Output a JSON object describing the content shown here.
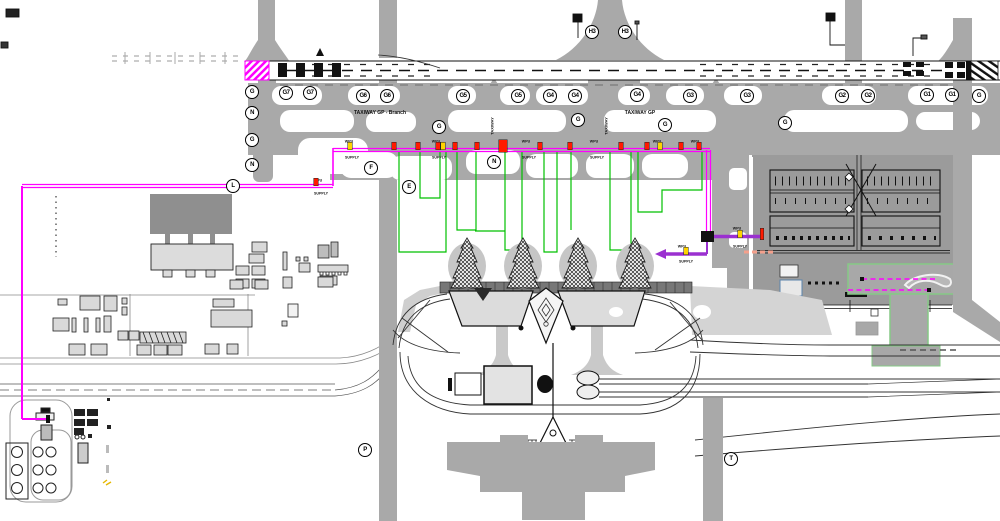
{
  "drawing": {
    "colors": {
      "magenta": "#FF00FF",
      "purple": "#9B30D0",
      "green": "#00C000",
      "red": "#FF1A00",
      "yellow": "#FFD300",
      "salmon": "#F4A08C",
      "band_gray": "#A9A9A9",
      "apron_gray": "#9B9B9B",
      "dark_gray": "#6E6E6E"
    },
    "circle_labels": [
      {
        "t": "G",
        "x": 252,
        "y": 92
      },
      {
        "t": "N",
        "x": 252,
        "y": 113
      },
      {
        "t": "G",
        "x": 252,
        "y": 140
      },
      {
        "t": "N",
        "x": 252,
        "y": 165
      },
      {
        "t": "G7",
        "x": 286,
        "y": 93
      },
      {
        "t": "G7",
        "x": 310,
        "y": 93
      },
      {
        "t": "G6",
        "x": 363,
        "y": 96
      },
      {
        "t": "G6",
        "x": 387,
        "y": 96
      },
      {
        "t": "G5",
        "x": 463,
        "y": 96
      },
      {
        "t": "G5",
        "x": 518,
        "y": 96
      },
      {
        "t": "G4",
        "x": 550,
        "y": 96
      },
      {
        "t": "G4",
        "x": 575,
        "y": 96
      },
      {
        "t": "G4",
        "x": 637,
        "y": 95
      },
      {
        "t": "G3",
        "x": 690,
        "y": 96
      },
      {
        "t": "G3",
        "x": 747,
        "y": 96
      },
      {
        "t": "G2",
        "x": 842,
        "y": 96
      },
      {
        "t": "G2",
        "x": 868,
        "y": 96
      },
      {
        "t": "G1",
        "x": 927,
        "y": 95
      },
      {
        "t": "G1",
        "x": 952,
        "y": 95
      },
      {
        "t": "G",
        "x": 979,
        "y": 96
      },
      {
        "t": "H3",
        "x": 592,
        "y": 32
      },
      {
        "t": "H3",
        "x": 625,
        "y": 32
      },
      {
        "t": "G",
        "x": 439,
        "y": 127
      },
      {
        "t": "G",
        "x": 578,
        "y": 120
      },
      {
        "t": "G",
        "x": 665,
        "y": 125
      },
      {
        "t": "G",
        "x": 785,
        "y": 123
      },
      {
        "t": "F",
        "x": 371,
        "y": 168
      },
      {
        "t": "N",
        "x": 494,
        "y": 162
      },
      {
        "t": "E",
        "x": 409,
        "y": 187
      },
      {
        "t": "L",
        "x": 233,
        "y": 186
      },
      {
        "t": "P",
        "x": 365,
        "y": 450
      },
      {
        "t": "T",
        "x": 731,
        "y": 459
      }
    ],
    "text_labels": [
      {
        "t": "TAXIWAY GP - Branch",
        "x": 380,
        "y": 113,
        "cls": "t5"
      },
      {
        "t": "TAXIWAY GP",
        "x": 640,
        "y": 113,
        "cls": "t5"
      },
      {
        "t": "TAXIWAY",
        "x": 492,
        "y": 126,
        "cls": "t4 vert"
      },
      {
        "t": "TAXIWAY",
        "x": 606,
        "y": 126,
        "cls": "t4 vert"
      },
      {
        "t": "WPU",
        "x": 349,
        "y": 141,
        "cls": "t4"
      },
      {
        "t": "SUPPLY",
        "x": 352,
        "y": 157,
        "cls": "t4"
      },
      {
        "t": "WPU",
        "x": 318,
        "y": 180,
        "cls": "t4"
      },
      {
        "t": "SUPPLY",
        "x": 321,
        "y": 193,
        "cls": "t4"
      },
      {
        "t": "WPU",
        "x": 436,
        "y": 141,
        "cls": "t4"
      },
      {
        "t": "SUPPLY",
        "x": 439,
        "y": 157,
        "cls": "t4"
      },
      {
        "t": "WPU",
        "x": 526,
        "y": 141,
        "cls": "t4"
      },
      {
        "t": "SUPPLY",
        "x": 529,
        "y": 157,
        "cls": "t4"
      },
      {
        "t": "WPU",
        "x": 594,
        "y": 141,
        "cls": "t4"
      },
      {
        "t": "SUPPLY",
        "x": 597,
        "y": 157,
        "cls": "t4"
      },
      {
        "t": "WPU",
        "x": 657,
        "y": 141,
        "cls": "t4"
      },
      {
        "t": "WPU",
        "x": 695,
        "y": 141,
        "cls": "t4"
      },
      {
        "t": "WPU",
        "x": 737,
        "y": 228,
        "cls": "t4"
      },
      {
        "t": "SUPPLY",
        "x": 740,
        "y": 246,
        "cls": "t4"
      },
      {
        "t": "WPU",
        "x": 682,
        "y": 246,
        "cls": "t4"
      },
      {
        "t": "SUPPLY",
        "x": 686,
        "y": 261,
        "cls": "t4"
      }
    ],
    "route_markers": [
      {
        "x": 350,
        "y": 146,
        "c": "yellow"
      },
      {
        "x": 394,
        "y": 146,
        "c": "red"
      },
      {
        "x": 418,
        "y": 146,
        "c": "red"
      },
      {
        "x": 438,
        "y": 146,
        "c": "red"
      },
      {
        "x": 443,
        "y": 146,
        "c": "yellow"
      },
      {
        "x": 455,
        "y": 146,
        "c": "red"
      },
      {
        "x": 477,
        "y": 146,
        "c": "red"
      },
      {
        "x": 503,
        "y": 146,
        "c": "red",
        "w": 8,
        "h": 12
      },
      {
        "x": 540,
        "y": 146,
        "c": "red"
      },
      {
        "x": 570,
        "y": 146,
        "c": "red"
      },
      {
        "x": 621,
        "y": 146,
        "c": "red"
      },
      {
        "x": 647,
        "y": 146,
        "c": "red"
      },
      {
        "x": 660,
        "y": 146,
        "c": "yellow"
      },
      {
        "x": 681,
        "y": 146,
        "c": "red"
      },
      {
        "x": 699,
        "y": 146,
        "c": "red"
      },
      {
        "x": 316,
        "y": 182,
        "c": "red"
      },
      {
        "x": 740,
        "y": 234,
        "c": "yellow"
      },
      {
        "x": 686,
        "y": 251,
        "c": "yellow"
      },
      {
        "x": 762,
        "y": 234,
        "c": "red",
        "w": 3,
        "h": 11
      }
    ]
  }
}
